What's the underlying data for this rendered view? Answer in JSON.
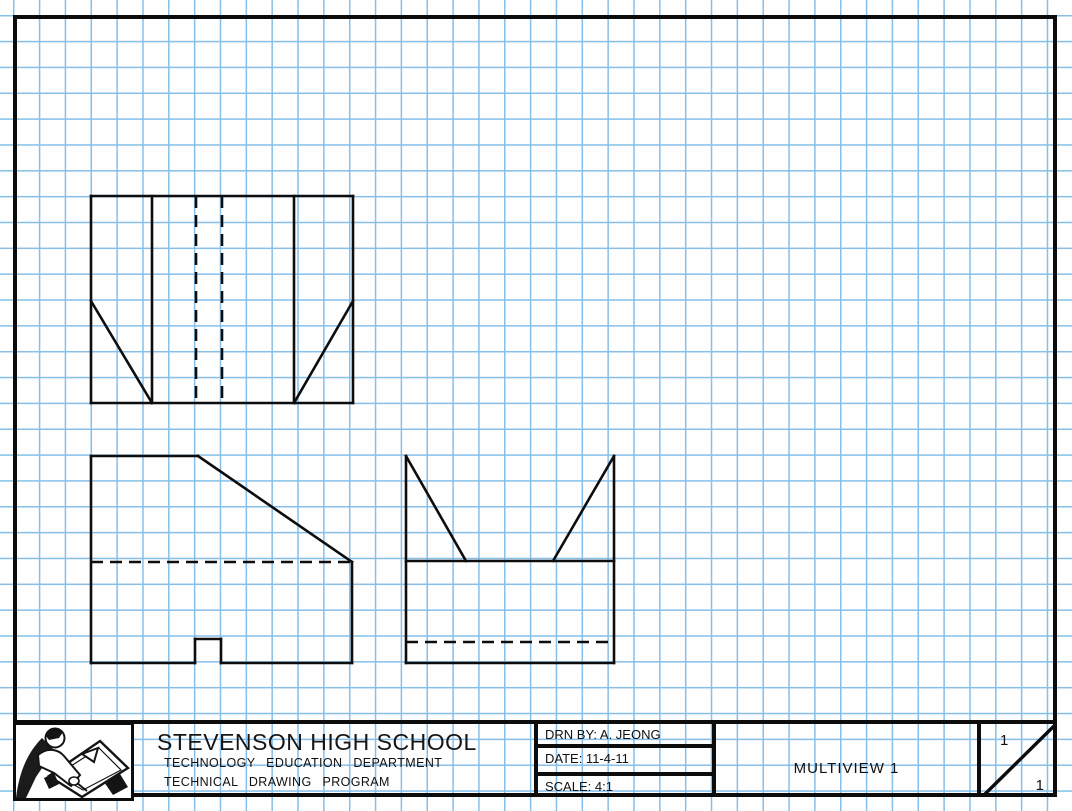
{
  "sheet": {
    "grid_color": "#85bfea",
    "line_color": "#0d0d0d",
    "grid_spacing_px": 26
  },
  "title_block": {
    "school": "STEVENSON HIGH SCHOOL",
    "dept_line1": "TECHNOLOGY EDUCATION DEPARTMENT",
    "dept_line2": "TECHNICAL DRAWING PROGRAM",
    "drn_by": "DRN BY: A. JEONG",
    "date": "DATE: 11-4-11",
    "scale": "SCALE: 4:1",
    "drawing_title": "MULTIVIEW 1",
    "sheet_number": "1",
    "sheet_total": "1"
  },
  "drawing": {
    "views": [
      {
        "name": "top-view",
        "solid": [
          [
            91,
            196,
            353,
            196
          ],
          [
            353,
            196,
            353,
            403
          ],
          [
            353,
            403,
            91,
            403
          ],
          [
            91,
            403,
            91,
            196
          ],
          [
            152,
            196,
            152,
            403
          ],
          [
            294,
            196,
            294,
            403
          ],
          [
            91,
            301,
            152,
            403
          ],
          [
            353,
            301,
            294,
            403
          ]
        ],
        "dashed": [
          [
            196,
            196,
            196,
            403
          ],
          [
            222,
            196,
            222,
            403
          ]
        ]
      },
      {
        "name": "front-view",
        "solid": [
          [
            91,
            456,
            198,
            456
          ],
          [
            198,
            456,
            352,
            562
          ],
          [
            352,
            562,
            352,
            663
          ],
          [
            352,
            663,
            221,
            663
          ],
          [
            221,
            663,
            221,
            639
          ],
          [
            221,
            639,
            195,
            639
          ],
          [
            195,
            639,
            195,
            663
          ],
          [
            195,
            663,
            91,
            663
          ],
          [
            91,
            663,
            91,
            456
          ]
        ],
        "dashed": [
          [
            91,
            562,
            352,
            562
          ]
        ]
      },
      {
        "name": "side-view",
        "solid": [
          [
            406,
            456,
            406,
            663
          ],
          [
            614,
            456,
            614,
            663
          ],
          [
            406,
            663,
            614,
            663
          ],
          [
            406,
            561,
            614,
            561
          ],
          [
            406,
            456,
            466,
            561
          ],
          [
            614,
            456,
            553,
            561
          ]
        ],
        "dashed": [
          [
            406,
            642,
            614,
            642
          ]
        ]
      }
    ]
  }
}
